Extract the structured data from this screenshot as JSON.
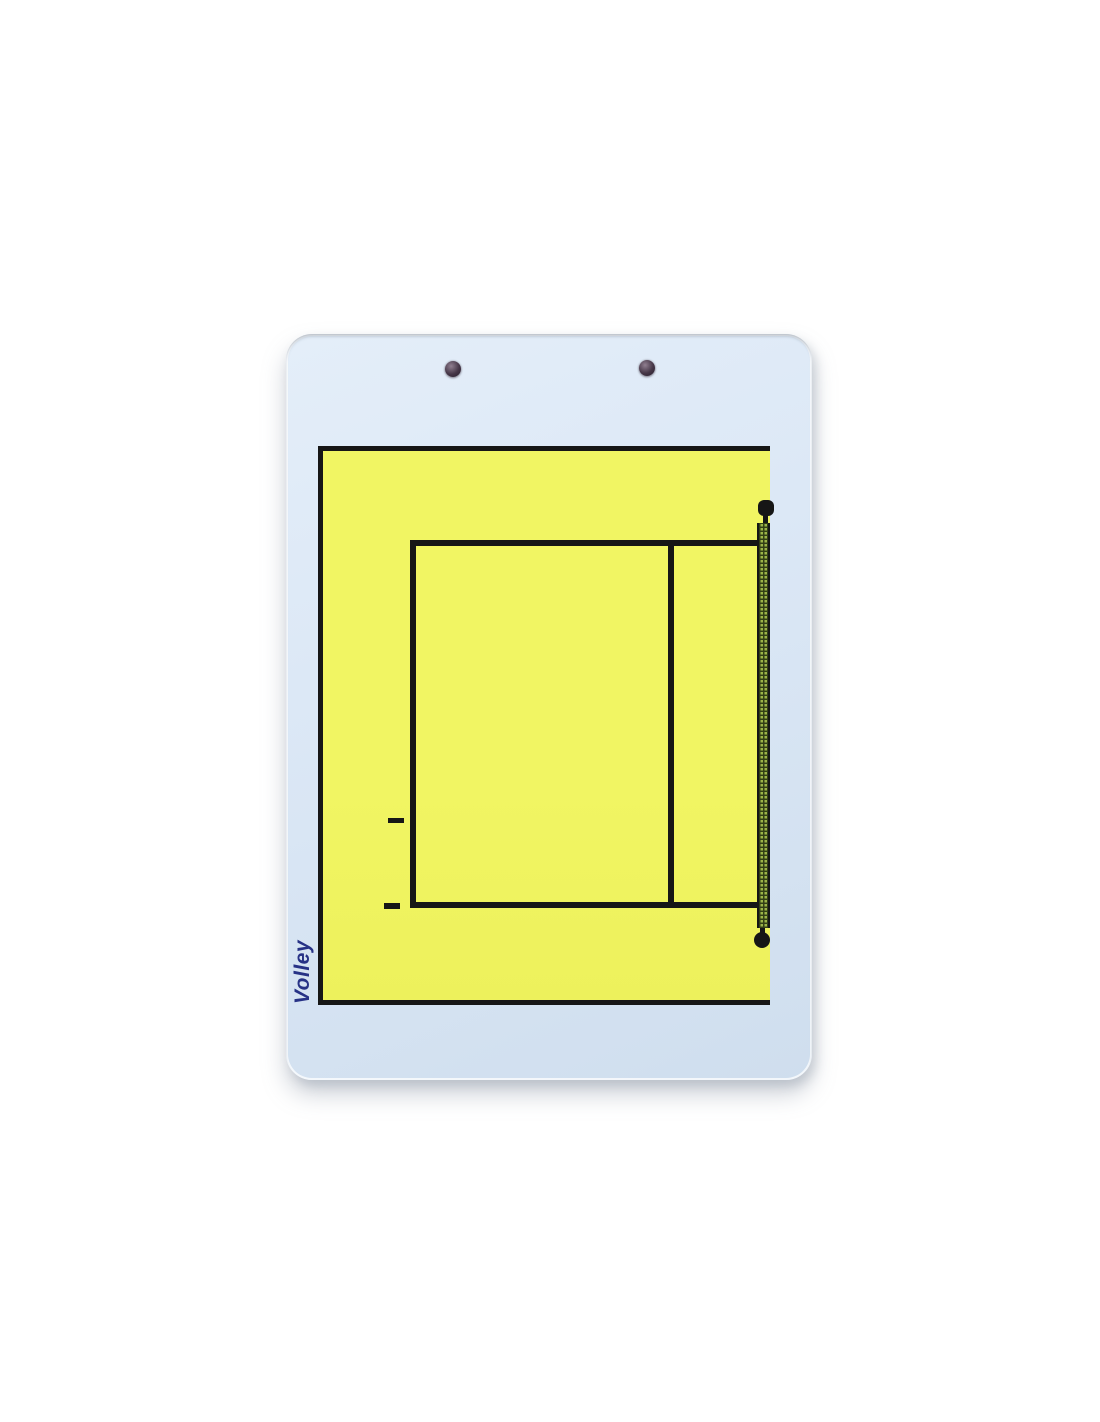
{
  "page": {
    "background": "#ffffff"
  },
  "board": {
    "brand": "Volley",
    "rivet_count": 2,
    "colors": {
      "board_face": "#dce8f6",
      "board_face_edge": "#cfdeee",
      "court_fill": "#f1f563",
      "line": "#161616",
      "brand_text": "#273286",
      "net_mesh_light": "#9cb449",
      "net_mesh_dark": "#333f15",
      "rivet_dark": "#453647",
      "rivet_light": "#907f90"
    },
    "diagram": {
      "type": "volleyball-half-court",
      "elements": [
        "free-zone-boundary",
        "court-outline",
        "attack-line",
        "service-mark-upper",
        "service-mark-lower",
        "net-strip",
        "net-knob-top",
        "net-knob-bottom"
      ]
    }
  }
}
